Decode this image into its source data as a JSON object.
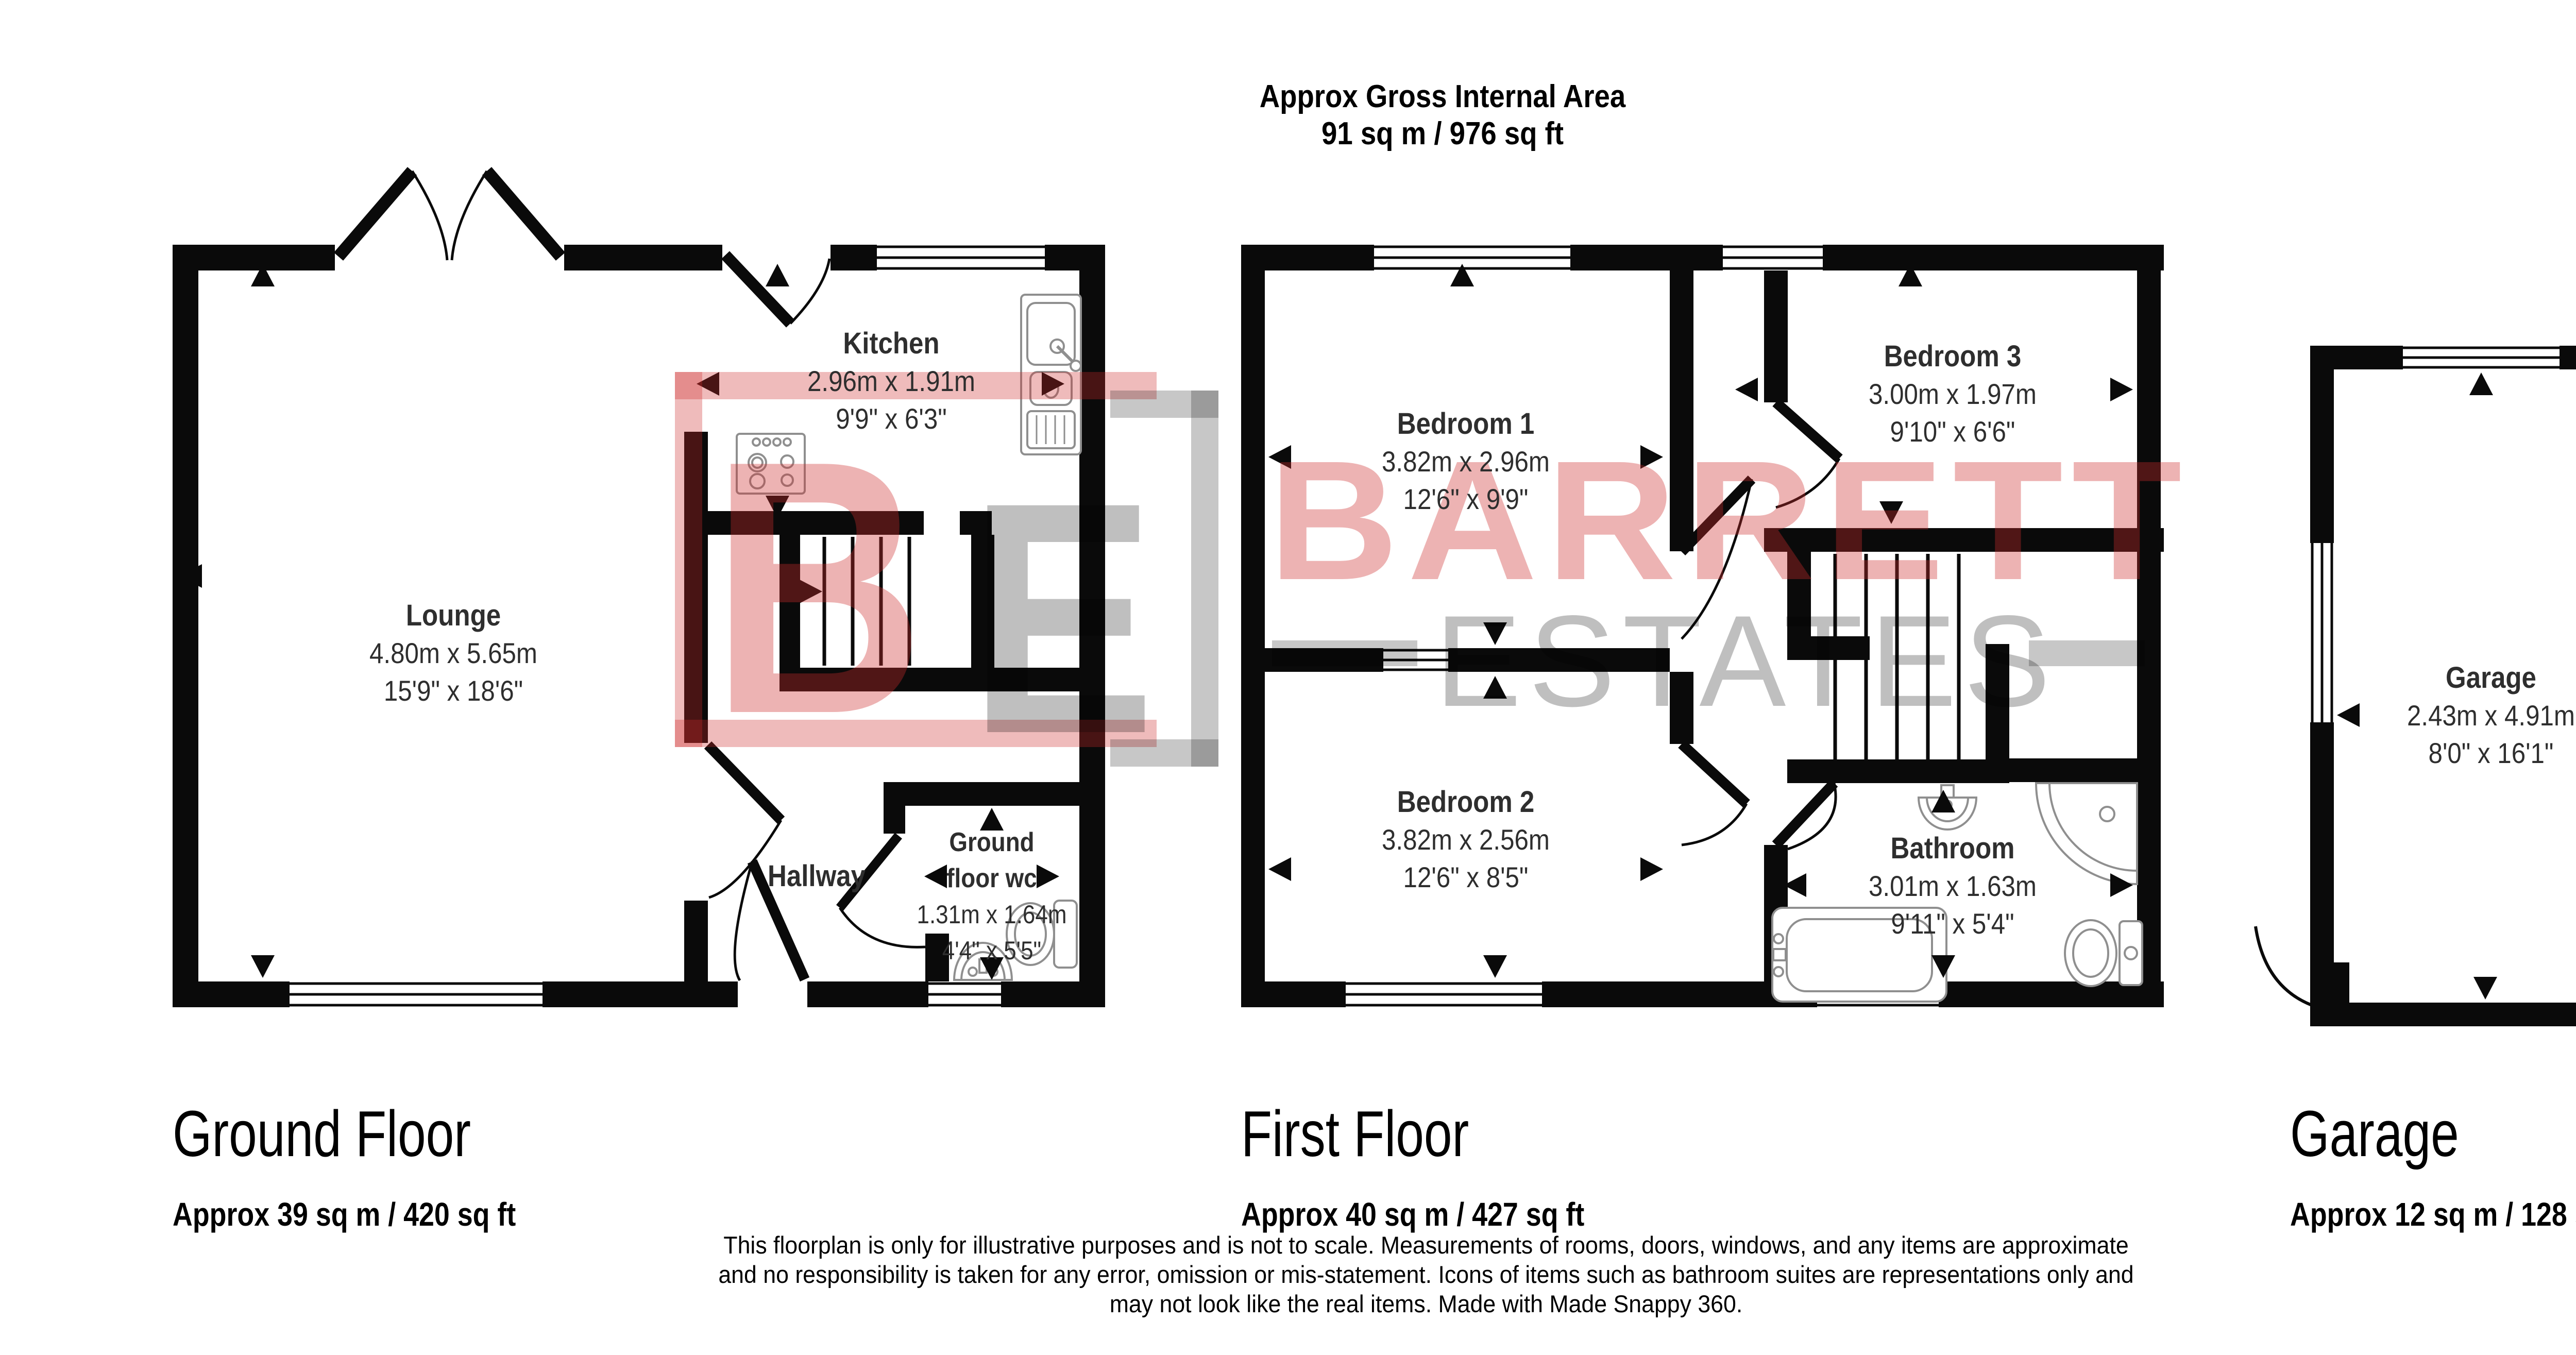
{
  "header": {
    "line1": "Approx Gross Internal Area",
    "line2": "91 sq m / 976 sq ft"
  },
  "watermark": {
    "monogram_b": "B",
    "monogram_e": "E",
    "word1": "BARRETT",
    "word2": "ESTATES"
  },
  "rooms": {
    "lounge": {
      "name": "Lounge",
      "metric": "4.80m x 5.65m",
      "imperial": "15'9\" x 18'6\""
    },
    "kitchen": {
      "name": "Kitchen",
      "metric": "2.96m x 1.91m",
      "imperial": "9'9\" x 6'3\""
    },
    "hallway": {
      "name": "Hallway"
    },
    "wc": {
      "name_line1": "Ground",
      "name_line2": "floor wc",
      "metric": "1.31m x 1.64m",
      "imperial": "4'4\" x 5'5\""
    },
    "bedroom1": {
      "name": "Bedroom 1",
      "metric": "3.82m x 2.96m",
      "imperial": "12'6\" x 9'9\""
    },
    "bedroom2": {
      "name": "Bedroom 2",
      "metric": "3.82m x 2.56m",
      "imperial": "12'6\" x 8'5\""
    },
    "bedroom3": {
      "name": "Bedroom 3",
      "metric": "3.00m x 1.97m",
      "imperial": "9'10\" x 6'6\""
    },
    "bathroom": {
      "name": "Bathroom",
      "metric": "3.01m x 1.63m",
      "imperial": "9'11\" x 5'4\""
    },
    "garage": {
      "name": "Garage",
      "metric": "2.43m x 4.91m",
      "imperial": "8'0\" x 16'1\""
    }
  },
  "floors": [
    {
      "title": "Ground Floor",
      "area": "Approx 39 sq m / 420 sq ft"
    },
    {
      "title": "First Floor",
      "area": "Approx 40 sq m / 427 sq ft"
    },
    {
      "title": "Garage",
      "area": "Approx 12 sq m / 128 sq ft"
    }
  ],
  "disclaimer": {
    "line1": "This floorplan is only for illustrative purposes and is not to scale. Measurements of rooms, doors, windows, and any items are approximate",
    "line2": "and no responsibility is taken for any error, omission or mis-statement. Icons of items such as bathroom suites are representations only and",
    "line3": "may not look like the real items. Made with Made Snappy 360."
  },
  "colors": {
    "wall": "#0a0a0a",
    "watermark_red": "#cd2d2d",
    "watermark_grey": "#9b9b9b"
  }
}
